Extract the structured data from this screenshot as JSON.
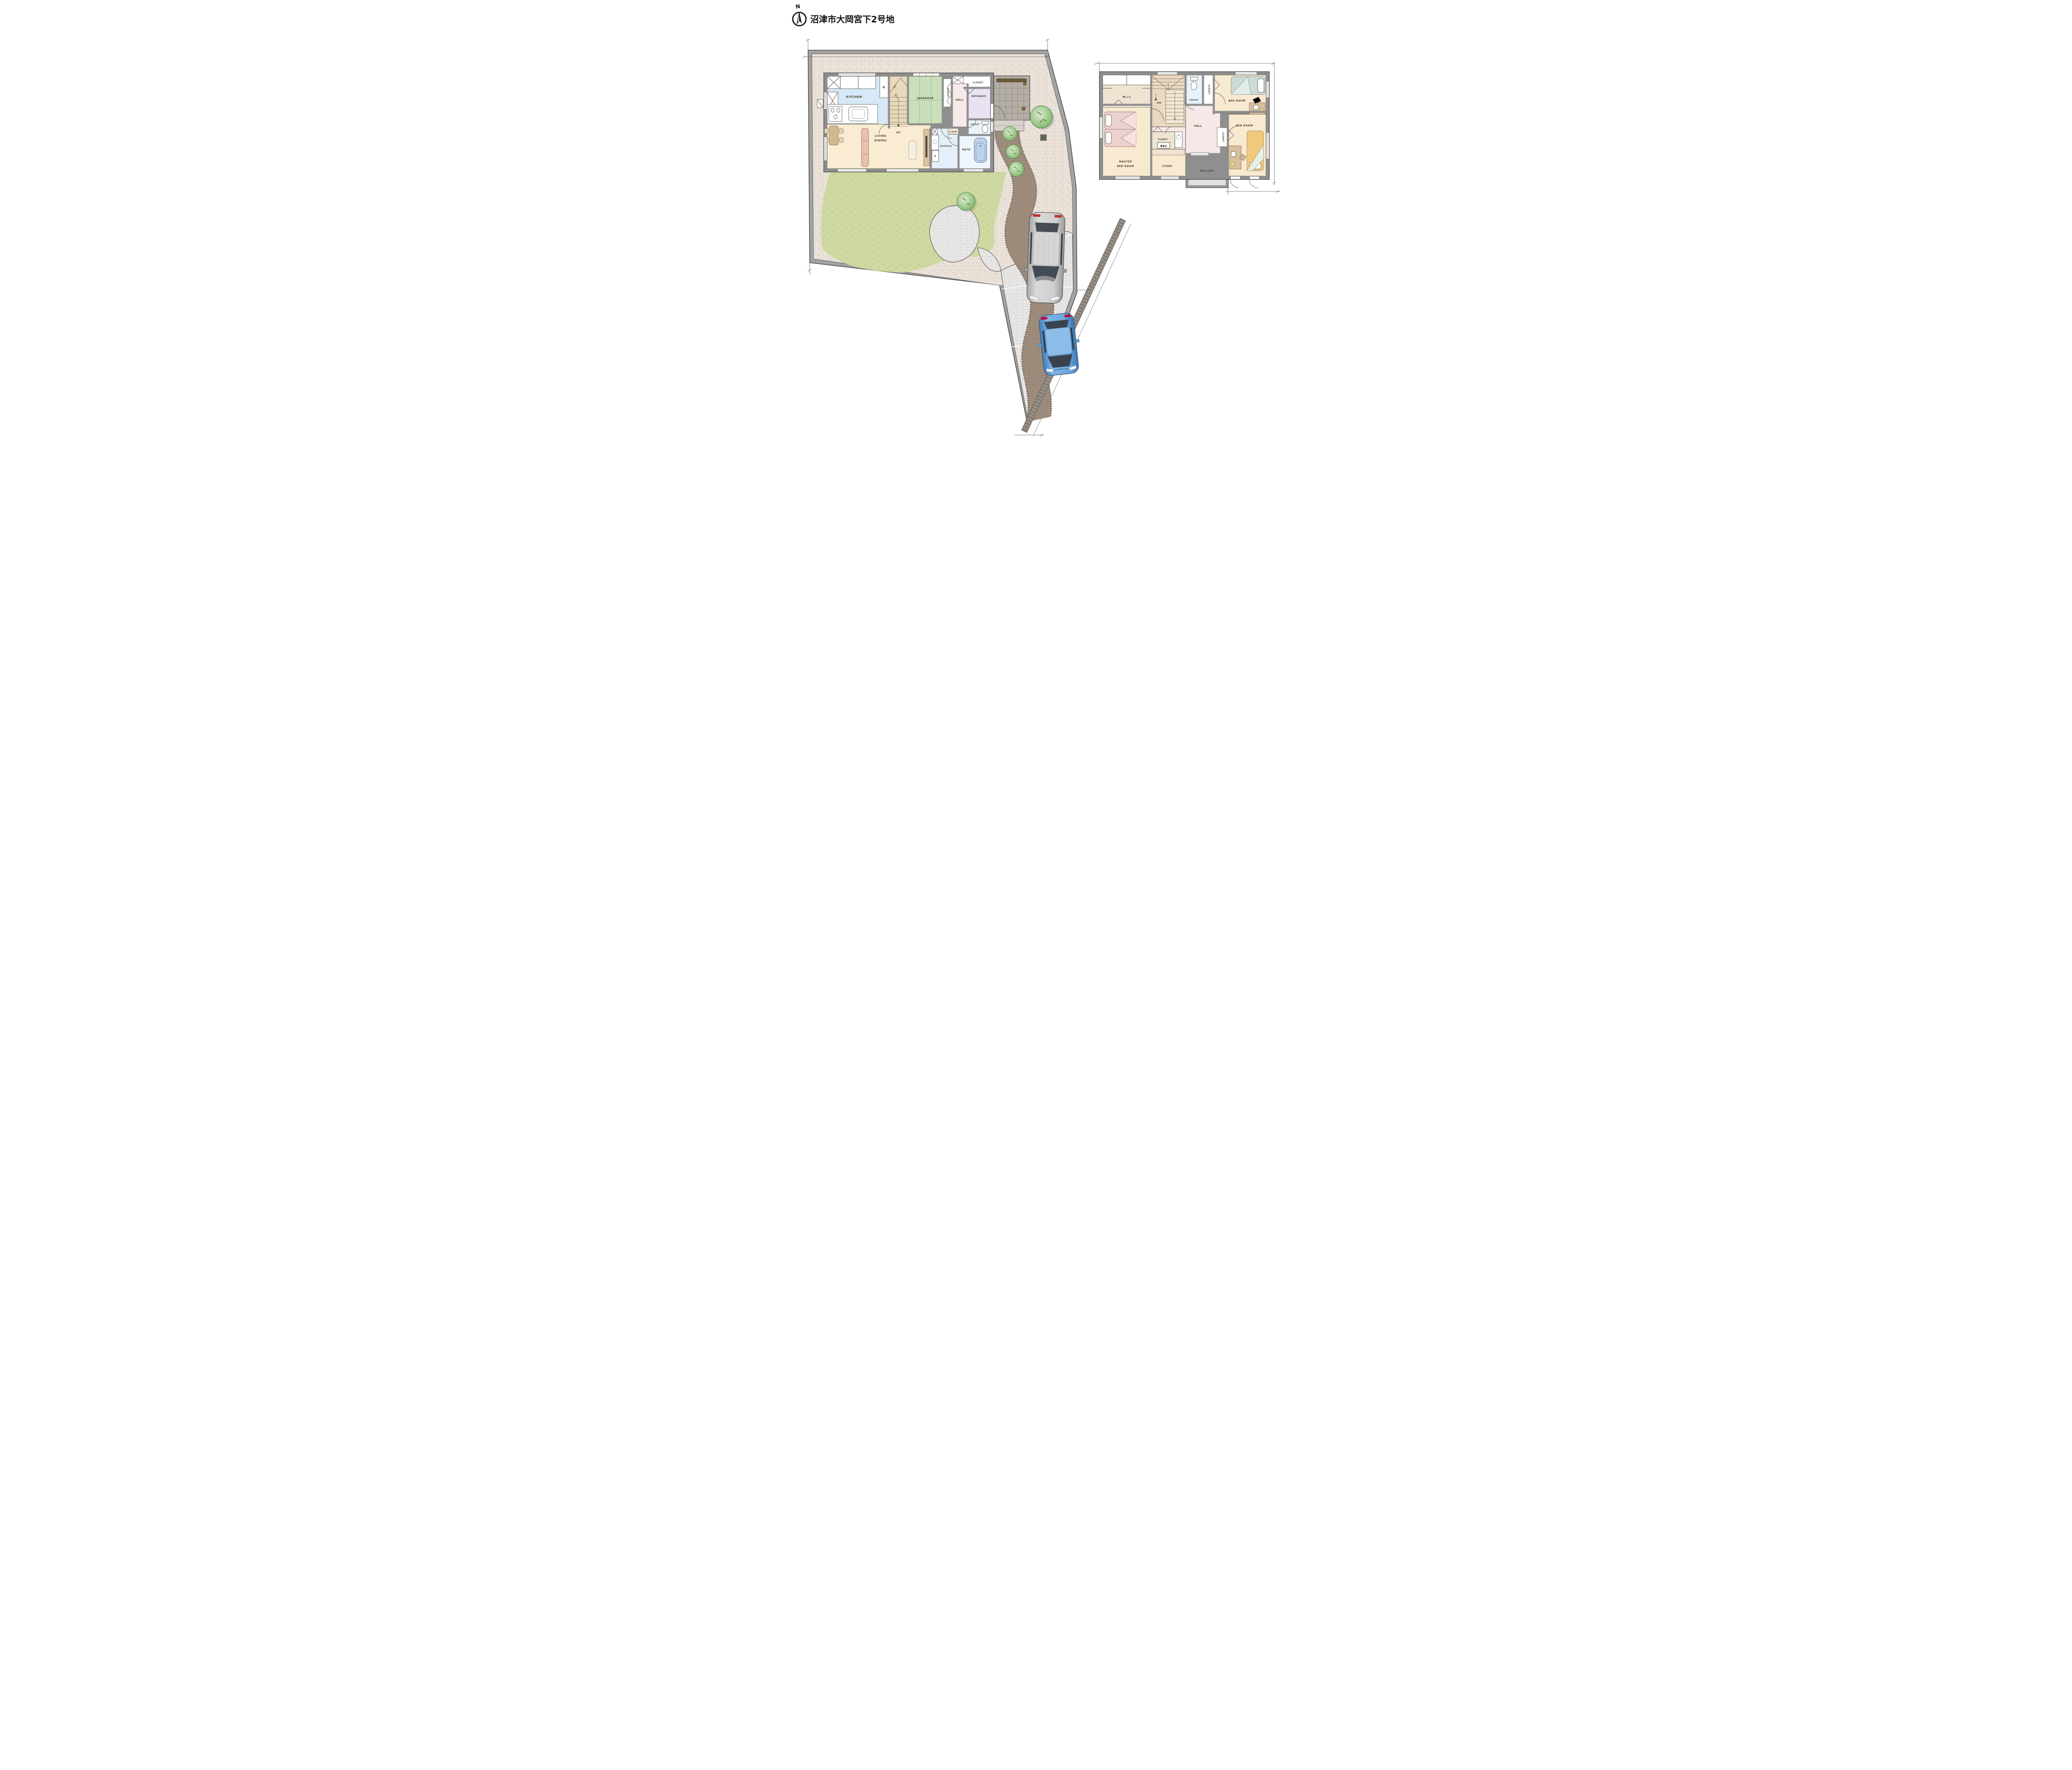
{
  "title": "沼津市大岡宮下2号地",
  "compass": {
    "north": "N"
  },
  "floor1": {
    "kitchen": "KITCHEN",
    "fridge": "R",
    "stairs": "UP",
    "japanese": "JAPANESE",
    "closet_japanese": "CLOSET",
    "closet_top": "CLOSET",
    "hall": "HALL",
    "entrance": "ENTRANCE",
    "toilet": "TOILET",
    "closet_mid": "CLOSET",
    "sanitary": "Sanitary",
    "washer": "S",
    "bath": "BATH",
    "living1": "LIVING",
    "living2": "DINING"
  },
  "floor2": {
    "wic": "W.I.C",
    "stairs": "DN",
    "toilet": "TOILET",
    "closet_top": "CLOSET",
    "bedroom_top": "BED ROOM",
    "master1": "MASTER",
    "master2": "BED ROOM",
    "hall": "HALL",
    "closet_mid": "CLOSET",
    "battery": "蓄電池",
    "study": "STUDY",
    "balcony": "BALCONY",
    "closet_right": "CLOSET",
    "bedroom_bottom": "BED ROOM"
  },
  "colors": {
    "kitchen_floor": "#d7e8f6",
    "tatami_green": "#c9dfba",
    "ldk_beige": "#f9ecd2",
    "hall_pink": "#f8e9e9",
    "entrance_lavender": "#e8e2f3",
    "bath_blue": "#eef6fd",
    "lawn_green": "#cfd9a2",
    "gravel_beige": "#eae1d9",
    "pavement_gray": "#e6e5e3",
    "path_brown": "#9d8c7c",
    "wall_gray": "#8f8f8f",
    "tree_green": "#8fbf7f",
    "car_gray": "#c9c9c9",
    "car_blue": "#5e9fd8",
    "balcony_gray": "#e2e1df"
  }
}
